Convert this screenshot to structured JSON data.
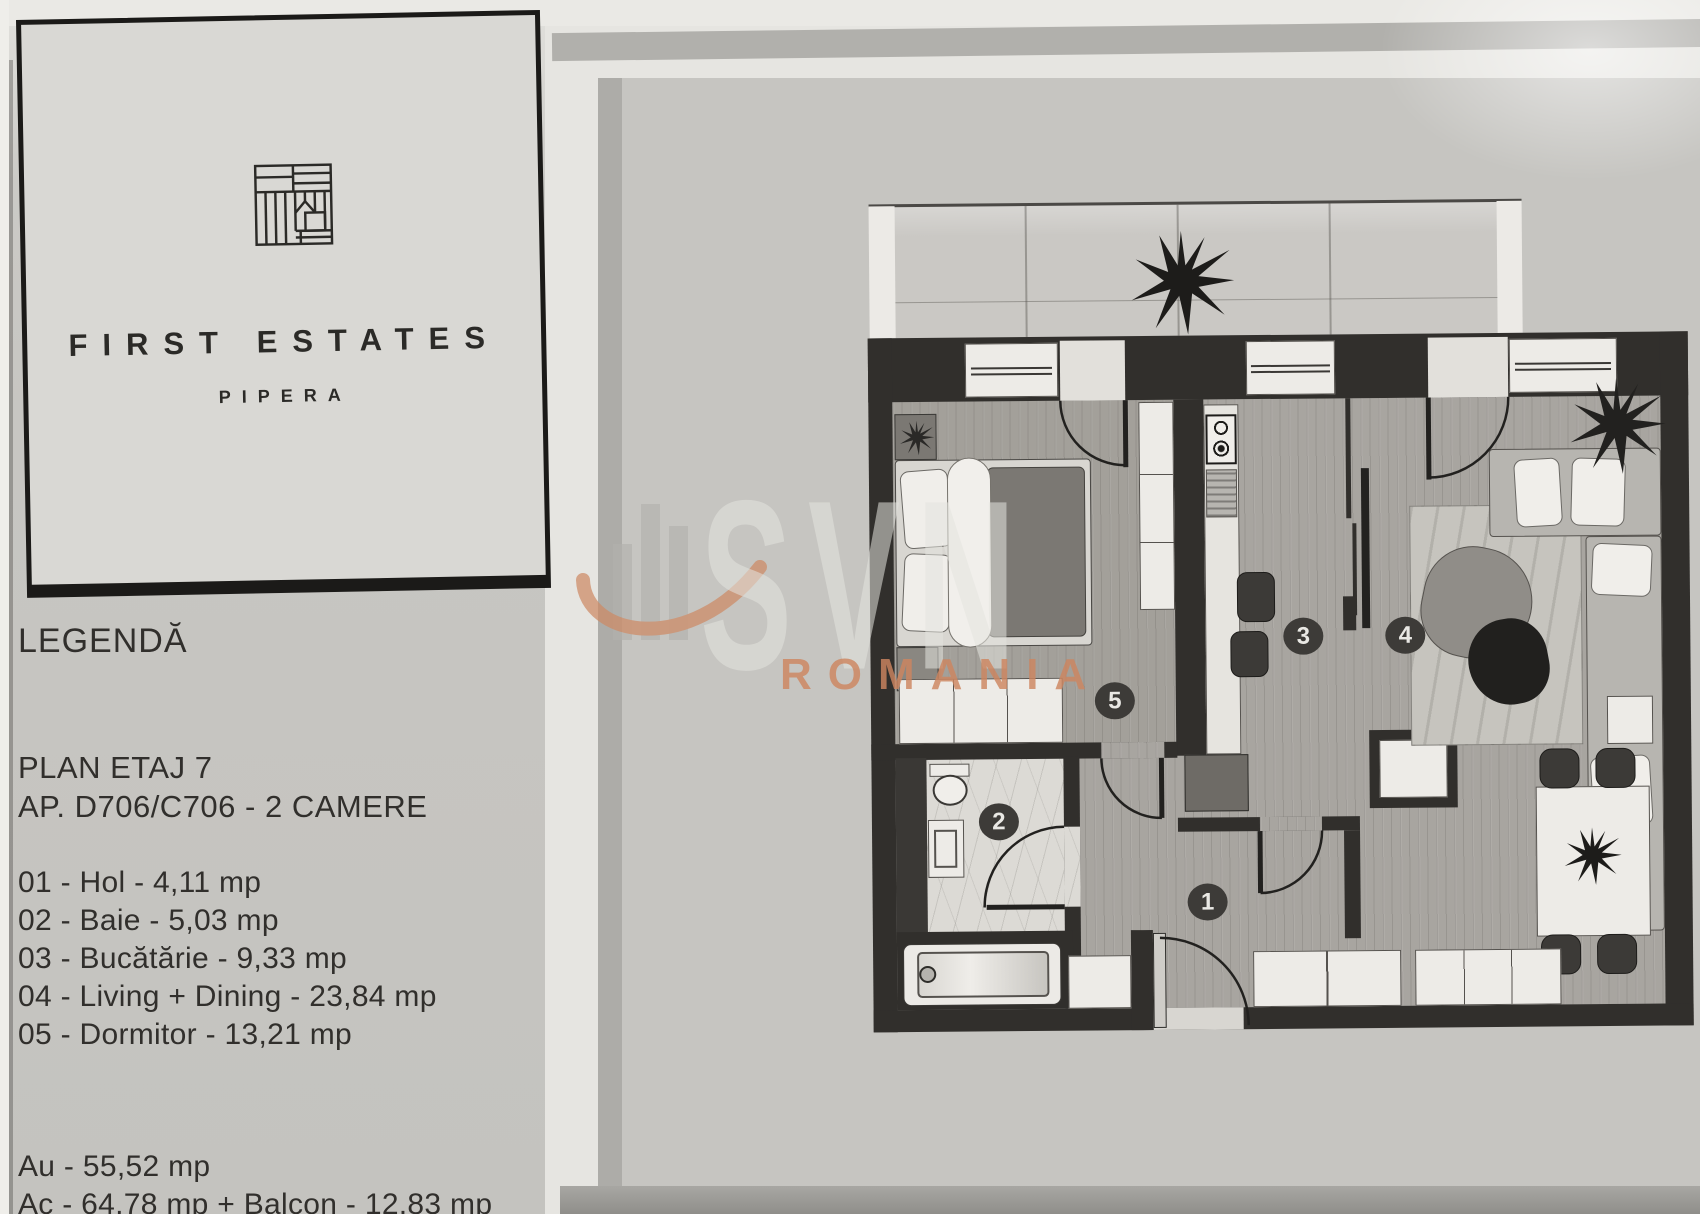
{
  "brand": {
    "name": "FIRST ESTATES",
    "location": "PIPERA"
  },
  "legend": {
    "title": "LEGENDĂ",
    "plan_floor": "PLAN ETAJ 7",
    "apartment": "AP. D706/C706 - 2 CAMERE",
    "rooms": [
      "01 - Hol - 4,11 mp",
      "02 - Baie - 5,03 mp",
      "03 - Bucătărie - 9,33 mp",
      "04 - Living + Dining - 23,84 mp",
      "05 - Dormitor - 13,21 mp"
    ],
    "area_useful": "Au - 55,52 mp",
    "area_built": "Ac - 64,78 mp + Balcon - 12,83 mp"
  },
  "watermark": {
    "name": "SVN",
    "region": "ROMANIA",
    "orange": "#cd8a64"
  },
  "floorplan": {
    "room_numbers": [
      "1",
      "2",
      "3",
      "4",
      "5"
    ],
    "wall_color": "#312f2c"
  }
}
